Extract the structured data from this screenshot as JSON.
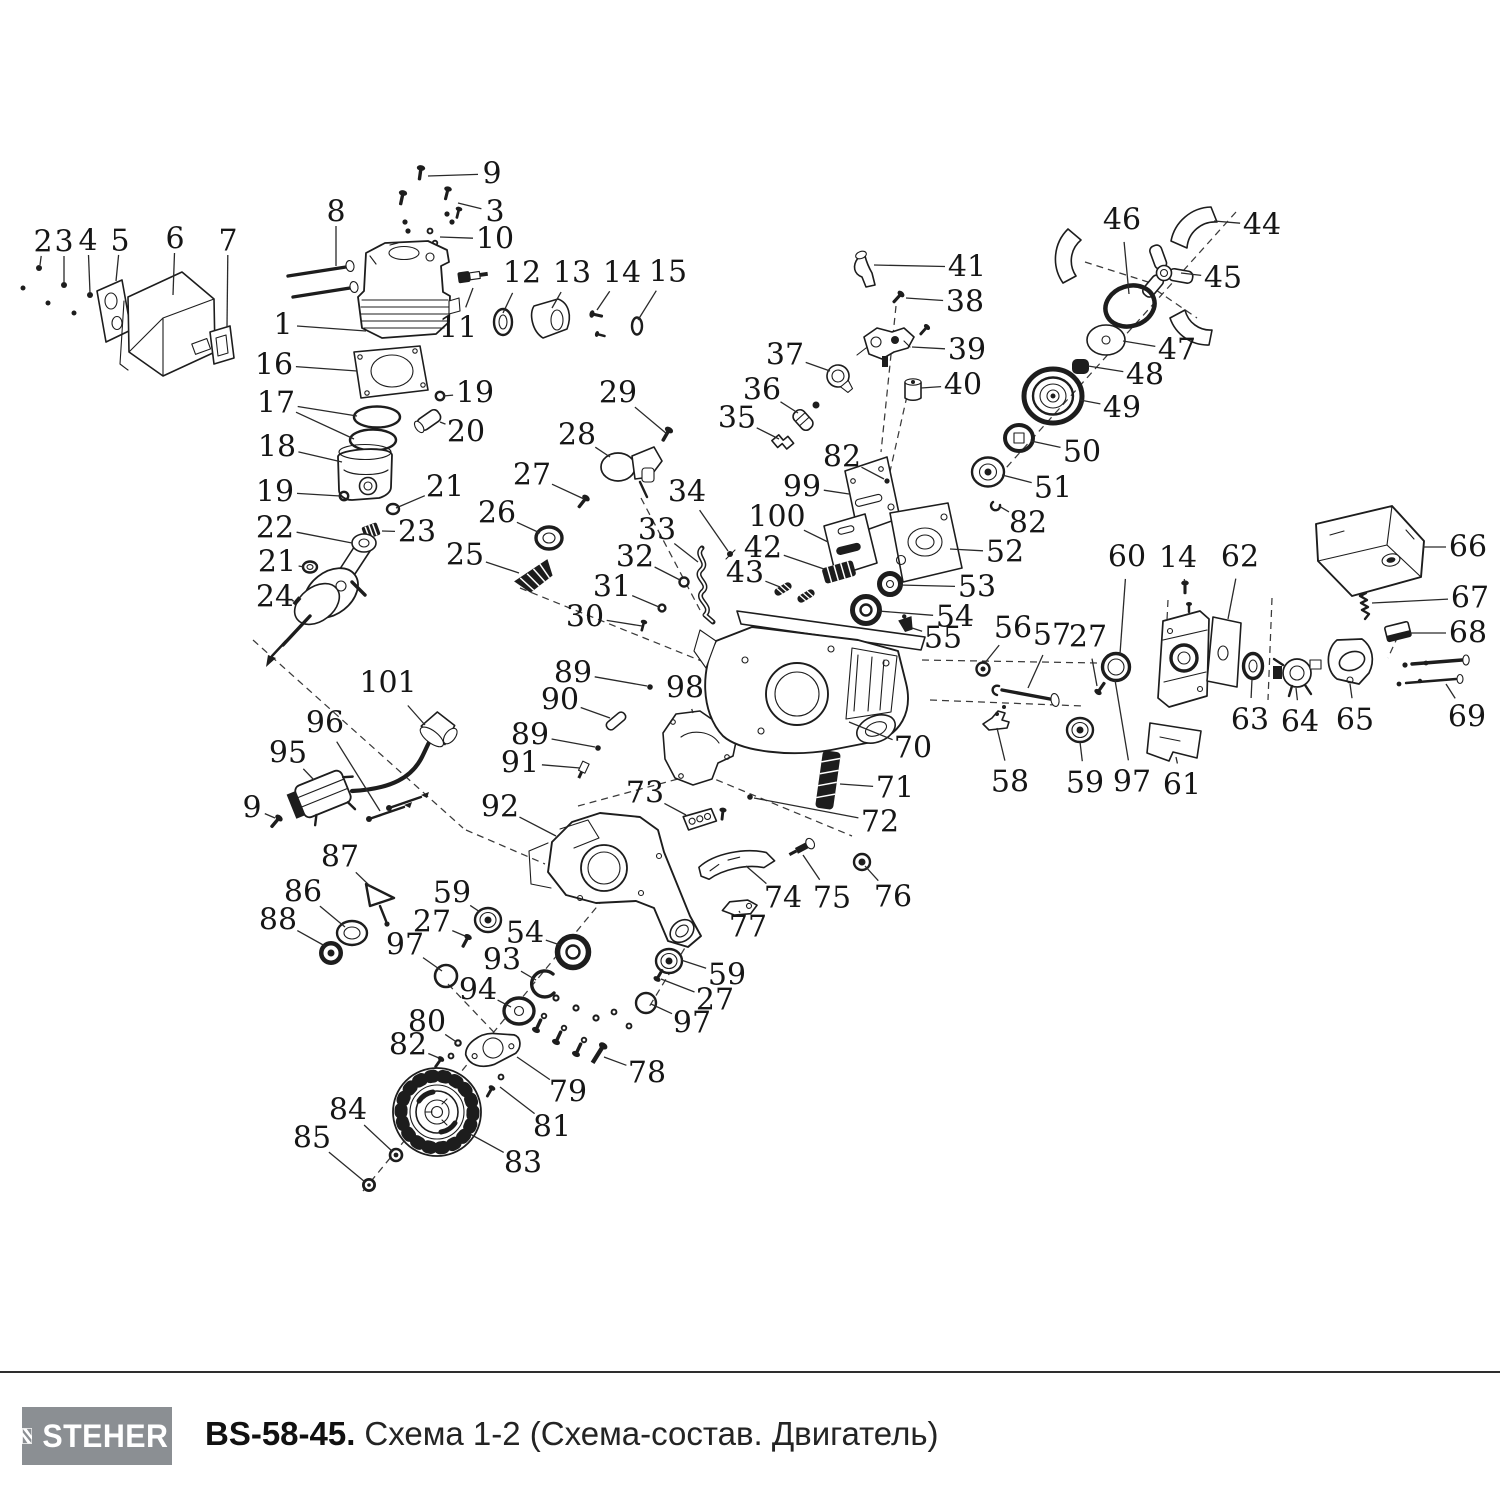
{
  "footer": {
    "brand": "STEHER",
    "model": "BS-58-45.",
    "title": "Схема 1-2 (Схема-состав. Двигатель)"
  },
  "colors": {
    "line": "#1d1d1d",
    "logo_bg": "#8b8f93",
    "text": "#161616"
  },
  "diagram": {
    "description": "exploded-view parts diagram of chainsaw engine, numbered parts 1-101",
    "labels": [
      {
        "n": "1",
        "x": 283,
        "y": 325,
        "tx": 366,
        "ty": 331
      },
      {
        "n": "2",
        "x": 43,
        "y": 242,
        "tx": 40,
        "ty": 265
      },
      {
        "n": "3",
        "x": 64,
        "y": 242,
        "tx": 64,
        "ty": 283
      },
      {
        "n": "4",
        "x": 88,
        "y": 241,
        "tx": 90,
        "ty": 293
      },
      {
        "n": "5",
        "x": 120,
        "y": 241,
        "tx": 116,
        "ty": 281
      },
      {
        "n": "6",
        "x": 175,
        "y": 239,
        "tx": 173,
        "ty": 295
      },
      {
        "n": "7",
        "x": 228,
        "y": 241,
        "tx": 227,
        "ty": 327
      },
      {
        "n": "8",
        "x": 336,
        "y": 212,
        "tx": 336,
        "ty": 266
      },
      {
        "n": "9",
        "x": 492,
        "y": 174,
        "tx": 428,
        "ty": 176
      },
      {
        "n": "3",
        "x": 495,
        "y": 212,
        "tx": 458,
        "ty": 203
      },
      {
        "n": "10",
        "x": 495,
        "y": 239,
        "tx": 440,
        "ty": 237
      },
      {
        "n": "11",
        "x": 458,
        "y": 328,
        "tx": 473,
        "ty": 288
      },
      {
        "n": "12",
        "x": 522,
        "y": 273,
        "tx": 503,
        "ty": 313
      },
      {
        "n": "13",
        "x": 572,
        "y": 273,
        "tx": 552,
        "ty": 308
      },
      {
        "n": "14",
        "x": 622,
        "y": 273,
        "tx": 597,
        "ty": 310
      },
      {
        "n": "15",
        "x": 668,
        "y": 272,
        "tx": 638,
        "ty": 320
      },
      {
        "n": "16",
        "x": 274,
        "y": 365,
        "tx": 357,
        "ty": 371
      },
      {
        "n": "17",
        "x": 276,
        "y": 403,
        "tx": 357,
        "ty": 416,
        "tx2": 354,
        "ty2": 439
      },
      {
        "n": "18",
        "x": 277,
        "y": 447,
        "tx": 342,
        "ty": 462
      },
      {
        "n": "19",
        "x": 475,
        "y": 393,
        "tx": 443,
        "ty": 396
      },
      {
        "n": "20",
        "x": 466,
        "y": 432,
        "tx": 440,
        "ty": 422
      },
      {
        "n": "19",
        "x": 275,
        "y": 492,
        "tx": 340,
        "ty": 496
      },
      {
        "n": "21",
        "x": 445,
        "y": 487,
        "tx": 396,
        "ty": 508
      },
      {
        "n": "22",
        "x": 275,
        "y": 528,
        "tx": 352,
        "ty": 543
      },
      {
        "n": "23",
        "x": 417,
        "y": 532,
        "tx": 382,
        "ty": 531
      },
      {
        "n": "21",
        "x": 277,
        "y": 562,
        "tx": 304,
        "ty": 567
      },
      {
        "n": "24",
        "x": 275,
        "y": 597,
        "tx": 294,
        "ty": 601
      },
      {
        "n": "25",
        "x": 465,
        "y": 555,
        "tx": 519,
        "ty": 573
      },
      {
        "n": "26",
        "x": 497,
        "y": 513,
        "tx": 540,
        "ty": 533
      },
      {
        "n": "27",
        "x": 532,
        "y": 475,
        "tx": 584,
        "ty": 499
      },
      {
        "n": "28",
        "x": 577,
        "y": 435,
        "tx": 610,
        "ty": 457
      },
      {
        "n": "29",
        "x": 618,
        "y": 393,
        "tx": 667,
        "ty": 434
      },
      {
        "n": "30",
        "x": 585,
        "y": 617,
        "tx": 642,
        "ty": 626
      },
      {
        "n": "31",
        "x": 612,
        "y": 587,
        "tx": 659,
        "ty": 607
      },
      {
        "n": "32",
        "x": 635,
        "y": 557,
        "tx": 680,
        "ty": 580
      },
      {
        "n": "33",
        "x": 657,
        "y": 530,
        "tx": 698,
        "ty": 562
      },
      {
        "n": "34",
        "x": 687,
        "y": 492,
        "tx": 728,
        "ty": 551
      },
      {
        "n": "35",
        "x": 737,
        "y": 418,
        "tx": 779,
        "ty": 439
      },
      {
        "n": "36",
        "x": 762,
        "y": 390,
        "tx": 798,
        "ty": 413
      },
      {
        "n": "37",
        "x": 785,
        "y": 355,
        "tx": 830,
        "ty": 371
      },
      {
        "n": "38",
        "x": 965,
        "y": 302,
        "tx": 906,
        "ty": 298
      },
      {
        "n": "39",
        "x": 967,
        "y": 350,
        "tx": 912,
        "ty": 347
      },
      {
        "n": "40",
        "x": 963,
        "y": 385,
        "tx": 921,
        "ty": 388
      },
      {
        "n": "41",
        "x": 967,
        "y": 267,
        "tx": 874,
        "ty": 265
      },
      {
        "n": "42",
        "x": 763,
        "y": 548,
        "tx": 824,
        "ty": 569
      },
      {
        "n": "43",
        "x": 745,
        "y": 573,
        "tx": 780,
        "ty": 587
      },
      {
        "n": "44",
        "x": 1262,
        "y": 225,
        "tx": 1214,
        "ty": 221
      },
      {
        "n": "45",
        "x": 1223,
        "y": 278,
        "tx": 1181,
        "ty": 273
      },
      {
        "n": "46",
        "x": 1122,
        "y": 220,
        "tx": 1129,
        "ty": 294
      },
      {
        "n": "47",
        "x": 1177,
        "y": 350,
        "tx": 1123,
        "ty": 341
      },
      {
        "n": "48",
        "x": 1145,
        "y": 375,
        "tx": 1088,
        "ty": 366
      },
      {
        "n": "49",
        "x": 1122,
        "y": 408,
        "tx": 1080,
        "ty": 400
      },
      {
        "n": "50",
        "x": 1082,
        "y": 452,
        "tx": 1031,
        "ty": 441
      },
      {
        "n": "51",
        "x": 1053,
        "y": 488,
        "tx": 1002,
        "ty": 475
      },
      {
        "n": "82",
        "x": 1028,
        "y": 523,
        "tx": 999,
        "ty": 506
      },
      {
        "n": "52",
        "x": 1005,
        "y": 552,
        "tx": 950,
        "ty": 549
      },
      {
        "n": "53",
        "x": 977,
        "y": 587,
        "tx": 899,
        "ty": 585
      },
      {
        "n": "54",
        "x": 955,
        "y": 617,
        "tx": 878,
        "ty": 611
      },
      {
        "n": "55",
        "x": 943,
        "y": 638,
        "tx": 912,
        "ty": 628
      },
      {
        "n": "56",
        "x": 1013,
        "y": 628,
        "tx": 984,
        "ty": 664
      },
      {
        "n": "57",
        "x": 1052,
        "y": 635,
        "tx": 1028,
        "ty": 688
      },
      {
        "n": "27",
        "x": 1088,
        "y": 637,
        "tx": 1097,
        "ty": 686
      },
      {
        "n": "58",
        "x": 1010,
        "y": 782,
        "tx": 997,
        "ty": 728
      },
      {
        "n": "59",
        "x": 1085,
        "y": 783,
        "tx": 1080,
        "ty": 742
      },
      {
        "n": "97",
        "x": 1132,
        "y": 782,
        "tx": 1115,
        "ty": 680
      },
      {
        "n": "61",
        "x": 1182,
        "y": 785,
        "tx": 1176,
        "ty": 757
      },
      {
        "n": "60",
        "x": 1127,
        "y": 557,
        "tx": 1120,
        "ty": 654
      },
      {
        "n": "14",
        "x": 1178,
        "y": 558,
        "tx": 1185,
        "ty": 582
      },
      {
        "n": "62",
        "x": 1240,
        "y": 557,
        "tx": 1228,
        "ty": 619
      },
      {
        "n": "63",
        "x": 1250,
        "y": 720,
        "tx": 1252,
        "ty": 679
      },
      {
        "n": "64",
        "x": 1300,
        "y": 722,
        "tx": 1296,
        "ty": 688
      },
      {
        "n": "65",
        "x": 1355,
        "y": 720,
        "tx": 1350,
        "ty": 684
      },
      {
        "n": "66",
        "x": 1468,
        "y": 547,
        "tx": 1423,
        "ty": 547
      },
      {
        "n": "67",
        "x": 1470,
        "y": 598,
        "tx": 1372,
        "ty": 603
      },
      {
        "n": "68",
        "x": 1468,
        "y": 633,
        "tx": 1410,
        "ty": 633
      },
      {
        "n": "69",
        "x": 1467,
        "y": 717,
        "tx": 1446,
        "ty": 684
      },
      {
        "n": "70",
        "x": 913,
        "y": 748,
        "tx": 849,
        "ty": 722
      },
      {
        "n": "71",
        "x": 895,
        "y": 788,
        "tx": 840,
        "ty": 784
      },
      {
        "n": "72",
        "x": 880,
        "y": 822,
        "tx": 754,
        "ty": 798
      },
      {
        "n": "73",
        "x": 645,
        "y": 793,
        "tx": 686,
        "ty": 815
      },
      {
        "n": "74",
        "x": 783,
        "y": 898,
        "tx": 746,
        "ty": 866
      },
      {
        "n": "75",
        "x": 832,
        "y": 898,
        "tx": 803,
        "ty": 855
      },
      {
        "n": "76",
        "x": 893,
        "y": 897,
        "tx": 865,
        "ty": 866
      },
      {
        "n": "77",
        "x": 748,
        "y": 927,
        "tx": 739,
        "ty": 911
      },
      {
        "n": "78",
        "x": 647,
        "y": 1073,
        "tx": 604,
        "ty": 1057
      },
      {
        "n": "79",
        "x": 568,
        "y": 1092,
        "tx": 517,
        "ty": 1057
      },
      {
        "n": "80",
        "x": 427,
        "y": 1022,
        "tx": 455,
        "ty": 1041
      },
      {
        "n": "81",
        "x": 552,
        "y": 1127,
        "tx": 500,
        "ty": 1087
      },
      {
        "n": "82",
        "x": 408,
        "y": 1045,
        "tx": 439,
        "ty": 1058
      },
      {
        "n": "82",
        "x": 842,
        "y": 457,
        "tx": 884,
        "ty": 479
      },
      {
        "n": "83",
        "x": 523,
        "y": 1163,
        "tx": 470,
        "ty": 1134
      },
      {
        "n": "84",
        "x": 348,
        "y": 1110,
        "tx": 393,
        "ty": 1152
      },
      {
        "n": "85",
        "x": 312,
        "y": 1138,
        "tx": 365,
        "ty": 1182
      },
      {
        "n": "86",
        "x": 303,
        "y": 892,
        "tx": 345,
        "ty": 927
      },
      {
        "n": "87",
        "x": 340,
        "y": 857,
        "tx": 371,
        "ty": 887
      },
      {
        "n": "88",
        "x": 278,
        "y": 920,
        "tx": 325,
        "ty": 946
      },
      {
        "n": "89",
        "x": 573,
        "y": 673,
        "tx": 647,
        "ty": 686
      },
      {
        "n": "90",
        "x": 560,
        "y": 700,
        "tx": 610,
        "ty": 718
      },
      {
        "n": "89",
        "x": 530,
        "y": 735,
        "tx": 595,
        "ty": 747
      },
      {
        "n": "91",
        "x": 520,
        "y": 763,
        "tx": 580,
        "ty": 768
      },
      {
        "n": "92",
        "x": 500,
        "y": 807,
        "tx": 556,
        "ty": 836
      },
      {
        "n": "93",
        "x": 502,
        "y": 960,
        "tx": 536,
        "ty": 980
      },
      {
        "n": "94",
        "x": 478,
        "y": 990,
        "tx": 511,
        "ty": 1007
      },
      {
        "n": "95",
        "x": 288,
        "y": 753,
        "tx": 314,
        "ty": 780
      },
      {
        "n": "96",
        "x": 325,
        "y": 723,
        "tx": 380,
        "ty": 811
      },
      {
        "n": "97",
        "x": 405,
        "y": 945,
        "tx": 442,
        "ty": 971
      },
      {
        "n": "97",
        "x": 692,
        "y": 1023,
        "tx": 651,
        "ty": 1004
      },
      {
        "n": "98",
        "x": 685,
        "y": 688,
        "tx": 693,
        "ty": 713
      },
      {
        "n": "99",
        "x": 802,
        "y": 487,
        "tx": 849,
        "ty": 494
      },
      {
        "n": "100",
        "x": 777,
        "y": 517,
        "tx": 828,
        "ty": 542
      },
      {
        "n": "101",
        "x": 388,
        "y": 683,
        "tx": 425,
        "ty": 725
      },
      {
        "n": "9",
        "x": 252,
        "y": 808,
        "tx": 275,
        "ty": 818
      },
      {
        "n": "27",
        "x": 432,
        "y": 922,
        "tx": 465,
        "ty": 936
      },
      {
        "n": "27",
        "x": 715,
        "y": 1000,
        "tx": 661,
        "ty": 979
      },
      {
        "n": "54",
        "x": 525,
        "y": 933,
        "tx": 560,
        "ty": 945
      },
      {
        "n": "59",
        "x": 452,
        "y": 893,
        "tx": 480,
        "ty": 912
      },
      {
        "n": "59",
        "x": 727,
        "y": 975,
        "tx": 681,
        "ty": 960
      }
    ]
  }
}
